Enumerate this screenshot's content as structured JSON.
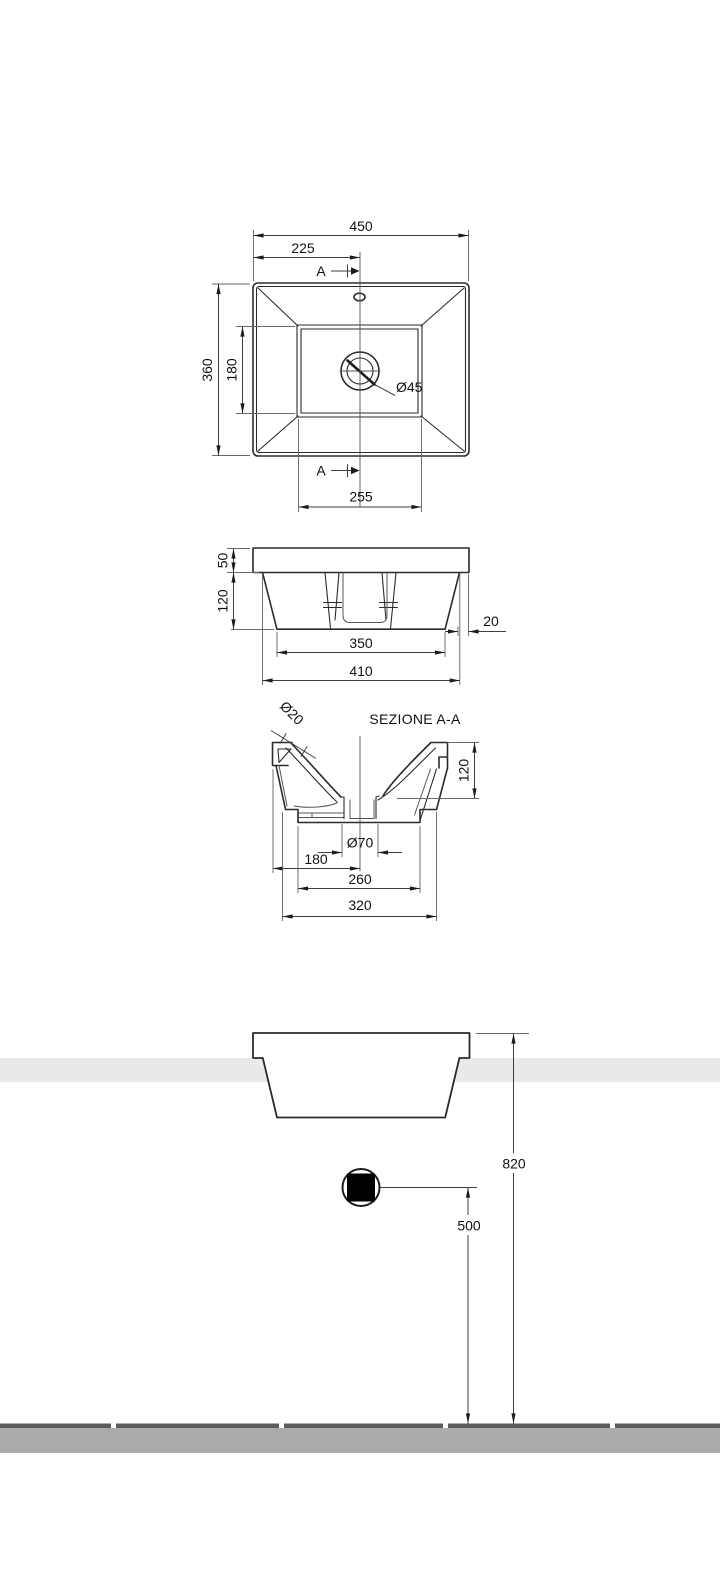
{
  "top_view": {
    "overall_width": "450",
    "center_offset": "225",
    "overall_depth": "360",
    "basin_inner_depth": "180",
    "drain_diameter": "Ø45",
    "basin_inner_width": "255",
    "section_letter": "A"
  },
  "front_view": {
    "rim_height": "50",
    "body_height": "120",
    "rim_overhang": "20",
    "bottom_width": "350",
    "body_top_width": "410"
  },
  "section_view": {
    "title": "SEZIONE A-A",
    "overflow_diameter": "Ø20",
    "bowl_depth": "120",
    "drain_hole_diameter": "Ø70",
    "drain_center_from_edge": "180",
    "foot_width": "260",
    "base_width": "320"
  },
  "installation_view": {
    "rim_height_from_floor": "820",
    "drain_height_from_floor": "500"
  },
  "colors": {
    "counter_band": "#e9e9e9",
    "floor_top": "#5c5c5c",
    "floor_band": "#ababab",
    "drain_fill": "#000000",
    "line": "#2b2b2b"
  }
}
